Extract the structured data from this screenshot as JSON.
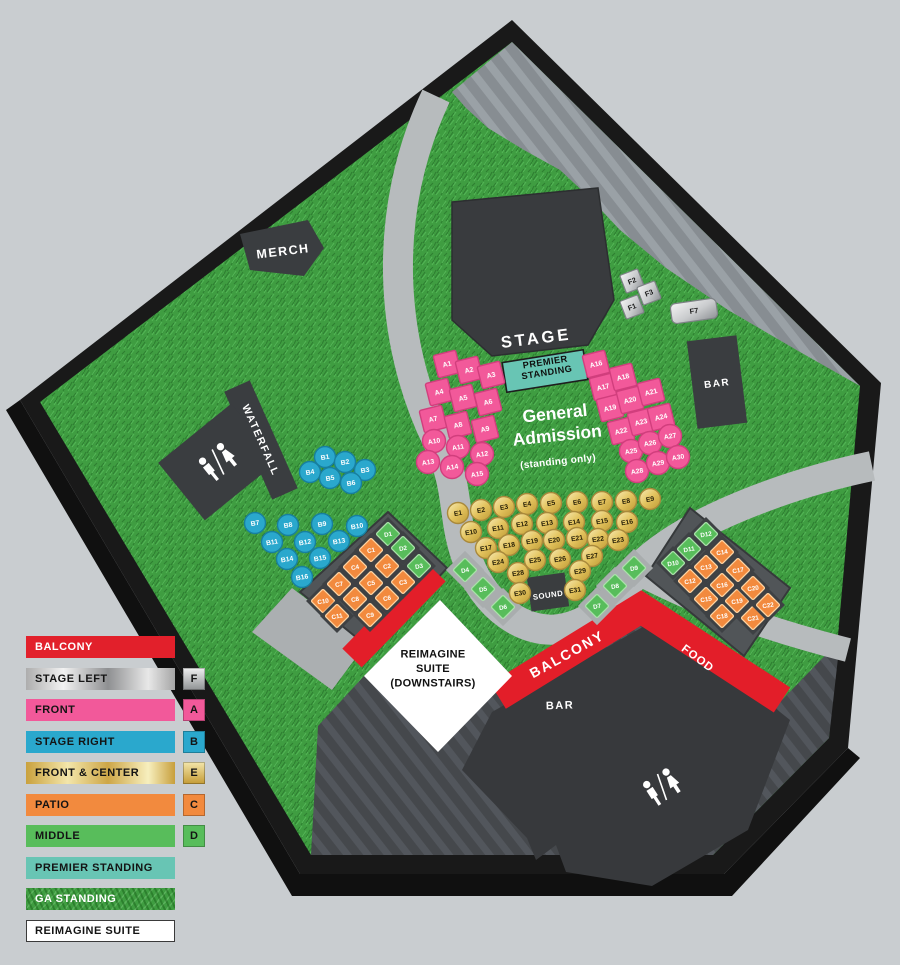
{
  "legend": {
    "rows": [
      {
        "label": "BALCONY",
        "kind": "red"
      },
      {
        "label": "STAGE LEFT",
        "kind": "silver",
        "letter": "F"
      },
      {
        "label": "FRONT",
        "kind": "pink",
        "letter": "A"
      },
      {
        "label": "STAGE RIGHT",
        "kind": "cyan",
        "letter": "B"
      },
      {
        "label": "FRONT & CENTER",
        "kind": "gold",
        "letter": "E"
      },
      {
        "label": "PATIO",
        "kind": "orange",
        "letter": "C"
      },
      {
        "label": "MIDDLE",
        "kind": "green",
        "letter": "D"
      },
      {
        "label": "PREMIER STANDING",
        "kind": "teal"
      },
      {
        "label": "GA STANDING",
        "kind": "grass"
      },
      {
        "label": "REIMAGINE SUITE",
        "kind": "white"
      }
    ]
  },
  "palette": {
    "front_pink": "#F2599A",
    "pink_border": "#D13E7D",
    "stage_right_cyan": "#2AA8CD",
    "cyan_border": "#177F9F",
    "patio_orange": "#F28A3E",
    "orange_border": "#FFD3A0",
    "middle_green": "#58BD5B",
    "green_border": "#A9E2A9",
    "balcony_red": "#E31E29",
    "premier_teal": "#68C5B4",
    "grass_base": "#3F9D41",
    "walkway_gray": "#B7BBBD",
    "roof_gray": "#878D92",
    "building_dark": "#3A3D40",
    "floor_dark": "#45484C"
  },
  "map": {
    "labels": [
      {
        "id": "stage",
        "text": "STAGE",
        "x": 536,
        "y": 338,
        "rot": -7,
        "size": 16.5,
        "color": "#fff",
        "ls": 3
      },
      {
        "id": "merch",
        "text": "MERCH",
        "x": 283,
        "y": 251,
        "rot": -7,
        "size": 12.5,
        "color": "#fff",
        "ls": 1.5
      },
      {
        "id": "waterfall",
        "text": "WATERFALL",
        "x": 261,
        "y": 440,
        "rot": 66,
        "size": 10.5,
        "color": "#fff",
        "ls": 1.5
      },
      {
        "id": "bar-upper",
        "text": "BAR",
        "x": 717,
        "y": 383,
        "rot": -7,
        "size": 10,
        "color": "#fff",
        "ls": 1.5
      },
      {
        "id": "premier-standing",
        "lines": [
          "PREMIER",
          "STANDING"
        ],
        "x": 546,
        "y": 367,
        "rot": -9,
        "size": 9.2,
        "color": "#10100f",
        "ls": 0.5,
        "lh": 10.5
      },
      {
        "id": "general-admission",
        "lines": [
          "General",
          "Admission"
        ],
        "x": 556,
        "y": 424,
        "rot": -6,
        "size": 17.5,
        "color": "#fff",
        "ls": 0,
        "lh": 22
      },
      {
        "id": "ga-sub",
        "text": "(standing only)",
        "x": 558,
        "y": 461,
        "rot": -6,
        "size": 10,
        "color": "#fff",
        "ls": 0.3
      },
      {
        "id": "sound",
        "text": "SOUND",
        "x": 548,
        "y": 595,
        "rot": -8,
        "size": 7.8,
        "color": "#fff",
        "ls": 0.5
      },
      {
        "id": "balcony",
        "text": "BALCONY",
        "x": 567,
        "y": 654,
        "rot": -29,
        "size": 14,
        "color": "#fff",
        "ls": 2
      },
      {
        "id": "food",
        "text": "FOOD",
        "x": 698,
        "y": 658,
        "rot": 37,
        "size": 11.5,
        "color": "#fff",
        "ls": 1
      },
      {
        "id": "bar-lower",
        "text": "BAR",
        "x": 560,
        "y": 705,
        "rot": -2,
        "size": 11,
        "color": "#fff",
        "ls": 1.5
      },
      {
        "id": "reimagine-suite",
        "lines": [
          "REIMAGINE",
          "SUITE",
          "(DOWNSTAIRS)"
        ],
        "x": 433,
        "y": 668,
        "rot": 0,
        "size": 11,
        "color": "#111",
        "ls": 0.3,
        "lh": 14.5
      }
    ],
    "sections": [
      {
        "name": "A",
        "legend": "FRONT",
        "seats": [
          {
            "id": "A1",
            "t": "sq",
            "x": 447,
            "y": 364
          },
          {
            "id": "A2",
            "t": "sq",
            "x": 469,
            "y": 370
          },
          {
            "id": "A3",
            "t": "sq",
            "x": 491,
            "y": 375
          },
          {
            "id": "A4",
            "t": "sq",
            "x": 439,
            "y": 392
          },
          {
            "id": "A5",
            "t": "sq",
            "x": 463,
            "y": 398
          },
          {
            "id": "A6",
            "t": "sq",
            "x": 488,
            "y": 402
          },
          {
            "id": "A7",
            "t": "sq",
            "x": 433,
            "y": 419
          },
          {
            "id": "A8",
            "t": "sq",
            "x": 458,
            "y": 425
          },
          {
            "id": "A9",
            "t": "sq",
            "x": 485,
            "y": 429
          },
          {
            "id": "A10",
            "t": "ci",
            "x": 434,
            "y": 441
          },
          {
            "id": "A11",
            "t": "ci",
            "x": 458,
            "y": 447
          },
          {
            "id": "A12",
            "t": "ci",
            "x": 482,
            "y": 454
          },
          {
            "id": "A13",
            "t": "ci",
            "x": 428,
            "y": 462
          },
          {
            "id": "A14",
            "t": "ci",
            "x": 452,
            "y": 467
          },
          {
            "id": "A15",
            "t": "ci",
            "x": 477,
            "y": 474
          },
          {
            "id": "A16",
            "t": "sq",
            "x": 596,
            "y": 364
          },
          {
            "id": "A17",
            "t": "sq",
            "x": 603,
            "y": 387
          },
          {
            "id": "A18",
            "t": "sq",
            "x": 623,
            "y": 377
          },
          {
            "id": "A19",
            "t": "sq",
            "x": 610,
            "y": 408
          },
          {
            "id": "A20",
            "t": "sq",
            "x": 630,
            "y": 400
          },
          {
            "id": "A21",
            "t": "sq",
            "x": 651,
            "y": 392
          },
          {
            "id": "A22",
            "t": "sq",
            "x": 621,
            "y": 431
          },
          {
            "id": "A23",
            "t": "sq",
            "x": 641,
            "y": 422
          },
          {
            "id": "A24",
            "t": "sq",
            "x": 661,
            "y": 417
          },
          {
            "id": "A25",
            "t": "ci",
            "x": 631,
            "y": 451
          },
          {
            "id": "A26",
            "t": "ci",
            "x": 650,
            "y": 443
          },
          {
            "id": "A27",
            "t": "ci",
            "x": 670,
            "y": 436
          },
          {
            "id": "A28",
            "t": "ci",
            "x": 637,
            "y": 471
          },
          {
            "id": "A29",
            "t": "ci",
            "x": 658,
            "y": 463
          },
          {
            "id": "A30",
            "t": "ci",
            "x": 678,
            "y": 457
          }
        ]
      },
      {
        "name": "B",
        "legend": "STAGE RIGHT",
        "seats": [
          {
            "id": "B1",
            "t": "ci",
            "x": 325,
            "y": 457
          },
          {
            "id": "B2",
            "t": "ci",
            "x": 345,
            "y": 462
          },
          {
            "id": "B3",
            "t": "ci",
            "x": 365,
            "y": 470
          },
          {
            "id": "B4",
            "t": "ci",
            "x": 310,
            "y": 472
          },
          {
            "id": "B5",
            "t": "ci",
            "x": 330,
            "y": 478
          },
          {
            "id": "B6",
            "t": "ci",
            "x": 351,
            "y": 483
          },
          {
            "id": "B7",
            "t": "ci",
            "x": 255,
            "y": 523
          },
          {
            "id": "B8",
            "t": "ci",
            "x": 288,
            "y": 525
          },
          {
            "id": "B9",
            "t": "ci",
            "x": 322,
            "y": 524
          },
          {
            "id": "B10",
            "t": "ci",
            "x": 357,
            "y": 526
          },
          {
            "id": "B11",
            "t": "ci",
            "x": 272,
            "y": 542
          },
          {
            "id": "B12",
            "t": "ci",
            "x": 305,
            "y": 542
          },
          {
            "id": "B13",
            "t": "ci",
            "x": 339,
            "y": 541
          },
          {
            "id": "B14",
            "t": "ci",
            "x": 287,
            "y": 559
          },
          {
            "id": "B15",
            "t": "ci",
            "x": 320,
            "y": 558
          },
          {
            "id": "B16",
            "t": "ci",
            "x": 302,
            "y": 577
          }
        ]
      },
      {
        "name": "C",
        "legend": "PATIO",
        "seats": [
          {
            "id": "C1",
            "t": "di",
            "x": 371,
            "y": 550
          },
          {
            "id": "C2",
            "t": "di",
            "x": 387,
            "y": 566
          },
          {
            "id": "C3",
            "t": "di",
            "x": 403,
            "y": 582
          },
          {
            "id": "C4",
            "t": "di",
            "x": 355,
            "y": 567
          },
          {
            "id": "C5",
            "t": "di",
            "x": 371,
            "y": 583
          },
          {
            "id": "C6",
            "t": "di",
            "x": 387,
            "y": 598
          },
          {
            "id": "C7",
            "t": "di",
            "x": 339,
            "y": 584
          },
          {
            "id": "C8",
            "t": "di",
            "x": 355,
            "y": 599
          },
          {
            "id": "C9",
            "t": "di",
            "x": 370,
            "y": 615
          },
          {
            "id": "C10",
            "t": "di",
            "x": 323,
            "y": 601
          },
          {
            "id": "C11",
            "t": "di",
            "x": 337,
            "y": 616
          },
          {
            "id": "C12",
            "t": "di",
            "x": 690,
            "y": 581
          },
          {
            "id": "C13",
            "t": "di",
            "x": 706,
            "y": 567
          },
          {
            "id": "C14",
            "t": "di",
            "x": 722,
            "y": 552
          },
          {
            "id": "C15",
            "t": "di",
            "x": 706,
            "y": 599
          },
          {
            "id": "C16",
            "t": "di",
            "x": 722,
            "y": 585
          },
          {
            "id": "C17",
            "t": "di",
            "x": 738,
            "y": 570
          },
          {
            "id": "C18",
            "t": "di",
            "x": 722,
            "y": 616
          },
          {
            "id": "C19",
            "t": "di",
            "x": 737,
            "y": 601
          },
          {
            "id": "C20",
            "t": "di",
            "x": 753,
            "y": 588
          },
          {
            "id": "C21",
            "t": "di",
            "x": 753,
            "y": 618
          },
          {
            "id": "C22",
            "t": "di",
            "x": 768,
            "y": 605
          }
        ]
      },
      {
        "name": "D",
        "legend": "MIDDLE",
        "seats": [
          {
            "id": "D1",
            "t": "di",
            "x": 388,
            "y": 534
          },
          {
            "id": "D2",
            "t": "di",
            "x": 403,
            "y": 548
          },
          {
            "id": "D3",
            "t": "di",
            "x": 419,
            "y": 566
          },
          {
            "id": "D4",
            "t": "di",
            "x": 465,
            "y": 570
          },
          {
            "id": "D5",
            "t": "di",
            "x": 483,
            "y": 589
          },
          {
            "id": "D6",
            "t": "di",
            "x": 503,
            "y": 607
          },
          {
            "id": "D7",
            "t": "di",
            "x": 597,
            "y": 606
          },
          {
            "id": "D8",
            "t": "di",
            "x": 615,
            "y": 586
          },
          {
            "id": "D9",
            "t": "di",
            "x": 634,
            "y": 568
          },
          {
            "id": "D10",
            "t": "di",
            "x": 673,
            "y": 563
          },
          {
            "id": "D11",
            "t": "di",
            "x": 689,
            "y": 549
          },
          {
            "id": "D12",
            "t": "di",
            "x": 706,
            "y": 534
          }
        ]
      },
      {
        "name": "E",
        "legend": "FRONT & CENTER",
        "seats": [
          {
            "id": "E1",
            "t": "ci",
            "x": 458,
            "y": 513
          },
          {
            "id": "E2",
            "t": "ci",
            "x": 481,
            "y": 510
          },
          {
            "id": "E3",
            "t": "ci",
            "x": 504,
            "y": 507
          },
          {
            "id": "E4",
            "t": "ci",
            "x": 527,
            "y": 504
          },
          {
            "id": "E5",
            "t": "ci",
            "x": 551,
            "y": 503
          },
          {
            "id": "E6",
            "t": "ci",
            "x": 577,
            "y": 502
          },
          {
            "id": "E7",
            "t": "ci",
            "x": 602,
            "y": 502
          },
          {
            "id": "E8",
            "t": "ci",
            "x": 626,
            "y": 501
          },
          {
            "id": "E9",
            "t": "ci",
            "x": 650,
            "y": 499
          },
          {
            "id": "E10",
            "t": "ci",
            "x": 471,
            "y": 532
          },
          {
            "id": "E11",
            "t": "ci",
            "x": 498,
            "y": 528
          },
          {
            "id": "E12",
            "t": "ci",
            "x": 522,
            "y": 524
          },
          {
            "id": "E13",
            "t": "ci",
            "x": 547,
            "y": 523
          },
          {
            "id": "E14",
            "t": "ci",
            "x": 574,
            "y": 522
          },
          {
            "id": "E15",
            "t": "ci",
            "x": 602,
            "y": 521
          },
          {
            "id": "E16",
            "t": "ci",
            "x": 627,
            "y": 522
          },
          {
            "id": "E17",
            "t": "ci",
            "x": 486,
            "y": 548
          },
          {
            "id": "E18",
            "t": "ci",
            "x": 509,
            "y": 545
          },
          {
            "id": "E19",
            "t": "ci",
            "x": 532,
            "y": 541
          },
          {
            "id": "E20",
            "t": "ci",
            "x": 554,
            "y": 540
          },
          {
            "id": "E21",
            "t": "ci",
            "x": 577,
            "y": 538
          },
          {
            "id": "E22",
            "t": "ci",
            "x": 598,
            "y": 539
          },
          {
            "id": "E23",
            "t": "ci",
            "x": 618,
            "y": 540
          },
          {
            "id": "E24",
            "t": "ci",
            "x": 498,
            "y": 562
          },
          {
            "id": "E25",
            "t": "ci",
            "x": 535,
            "y": 560
          },
          {
            "id": "E26",
            "t": "ci",
            "x": 560,
            "y": 559
          },
          {
            "id": "E27",
            "t": "ci",
            "x": 592,
            "y": 556
          },
          {
            "id": "E28",
            "t": "ci",
            "x": 518,
            "y": 573
          },
          {
            "id": "E29",
            "t": "ci",
            "x": 580,
            "y": 571
          },
          {
            "id": "E30",
            "t": "ci",
            "x": 520,
            "y": 593
          },
          {
            "id": "E31",
            "t": "ci",
            "x": 575,
            "y": 590
          }
        ]
      },
      {
        "name": "F",
        "legend": "STAGE LEFT",
        "seats": [
          {
            "id": "F1",
            "t": "fs",
            "x": 632,
            "y": 307
          },
          {
            "id": "F2",
            "t": "fs",
            "x": 632,
            "y": 281
          },
          {
            "id": "F3",
            "t": "fs",
            "x": 649,
            "y": 293
          },
          {
            "id": "F7",
            "t": "fc",
            "x": 694,
            "y": 311
          }
        ]
      }
    ]
  }
}
